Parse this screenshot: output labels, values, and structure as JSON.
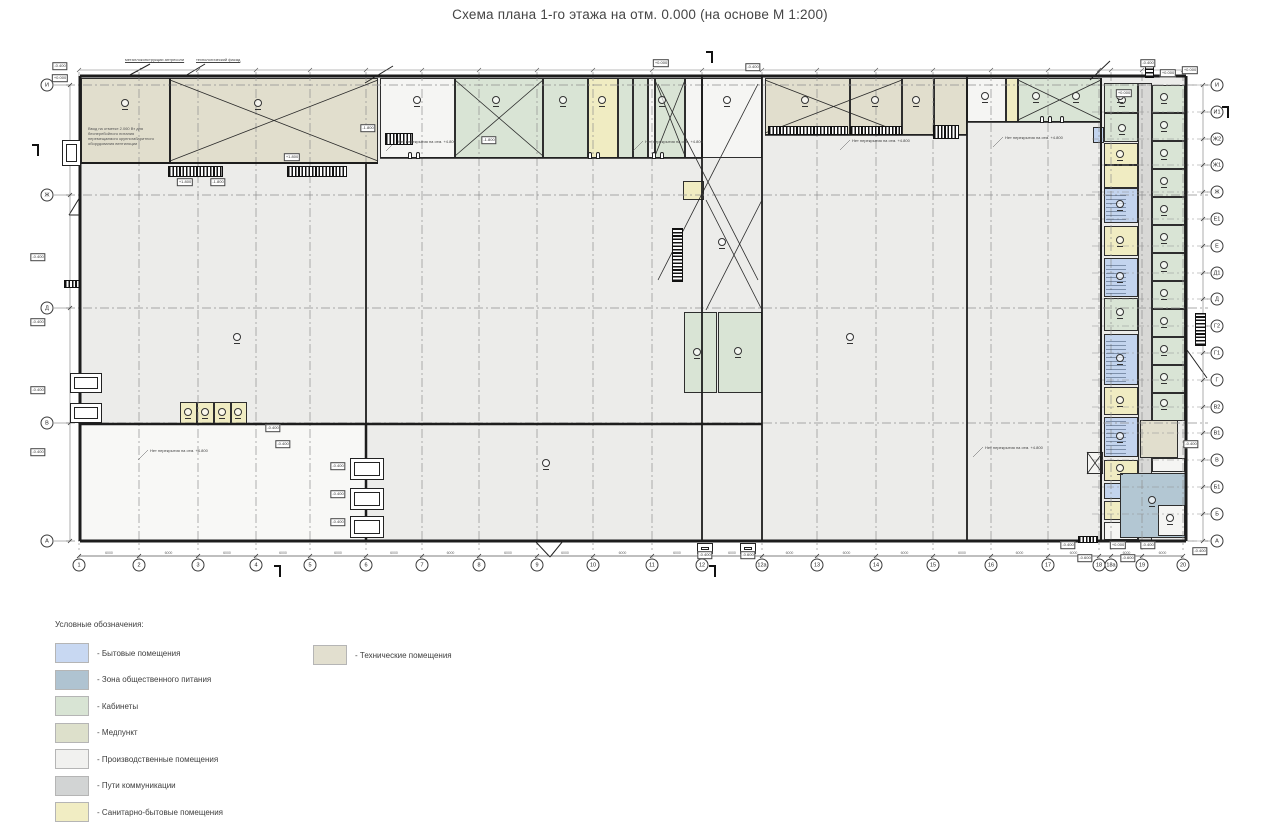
{
  "title": "Схема плана 1-го этажа на отм. 0.000 (на основе М 1:200)",
  "legend": {
    "title": "Условные обозначения:",
    "col1": [
      {
        "label": "- Бытовые помещения",
        "color": "#c8d8f2"
      },
      {
        "label": "- Зона общественного питания",
        "color": "#afc3d1"
      },
      {
        "label": "- Кабинеты",
        "color": "#d8e4d4"
      },
      {
        "label": "- Медпункт",
        "color": "#dde0cb"
      },
      {
        "label": "- Производственные помещения",
        "color": "#f1f1ef"
      },
      {
        "label": "- Пути коммуникации",
        "color": "#d2d4d4"
      },
      {
        "label": "- Санитарно-бытовые помещения",
        "color": "#f1edc3"
      }
    ],
    "col2": [
      {
        "label": "- Технические помещения",
        "color": "#e2dfcf"
      }
    ]
  },
  "colors": {
    "tech": "#e1decd",
    "green": "#d9e4d5",
    "sanitary": "#f0ecc2",
    "blue": "#c3d4ee",
    "bluegray": "#b3c7d3",
    "comm": "#d8d8d6",
    "white": "#f5f5f3",
    "floor": "#ececea",
    "cold": "#f8f8f6",
    "wall": "#1d1d1d",
    "grid": "#8f8f8f"
  },
  "axes": {
    "bottom": {
      "y": 565,
      "items": [
        {
          "label": "1",
          "x": 79
        },
        {
          "label": "2",
          "x": 139
        },
        {
          "label": "3",
          "x": 198
        },
        {
          "label": "4",
          "x": 256
        },
        {
          "label": "5",
          "x": 310
        },
        {
          "label": "6",
          "x": 366
        },
        {
          "label": "7",
          "x": 422
        },
        {
          "label": "8",
          "x": 479
        },
        {
          "label": "9",
          "x": 537
        },
        {
          "label": "10",
          "x": 593
        },
        {
          "label": "11",
          "x": 652
        },
        {
          "label": "12",
          "x": 702
        },
        {
          "label": "12а",
          "x": 762
        },
        {
          "label": "13",
          "x": 817
        },
        {
          "label": "14",
          "x": 876
        },
        {
          "label": "15",
          "x": 933
        },
        {
          "label": "16",
          "x": 991
        },
        {
          "label": "17",
          "x": 1048
        },
        {
          "label": "18",
          "x": 1099
        },
        {
          "label": "18а",
          "x": 1111
        },
        {
          "label": "19",
          "x": 1142
        },
        {
          "label": "20",
          "x": 1183
        }
      ]
    },
    "left": {
      "x": 47,
      "items": [
        {
          "label": "И",
          "y": 85
        },
        {
          "label": "Ж",
          "y": 195
        },
        {
          "label": "Д",
          "y": 308
        },
        {
          "label": "В",
          "y": 423
        },
        {
          "label": "А",
          "y": 541
        }
      ]
    },
    "right": {
      "x": 1217,
      "items": [
        {
          "label": "И",
          "y": 85
        },
        {
          "label": "И1",
          "y": 112
        },
        {
          "label": "Ж2",
          "y": 139
        },
        {
          "label": "Ж1",
          "y": 165
        },
        {
          "label": "Ж",
          "y": 192
        },
        {
          "label": "Е1",
          "y": 219
        },
        {
          "label": "Е",
          "y": 246
        },
        {
          "label": "Д1",
          "y": 273
        },
        {
          "label": "Д",
          "y": 299
        },
        {
          "label": "Г2",
          "y": 326
        },
        {
          "label": "Г1",
          "y": 353
        },
        {
          "label": "Г",
          "y": 380
        },
        {
          "label": "В2",
          "y": 407
        },
        {
          "label": "В1",
          "y": 433
        },
        {
          "label": "В",
          "y": 460
        },
        {
          "label": "Б1",
          "y": 487
        },
        {
          "label": "Б",
          "y": 514
        },
        {
          "label": "А",
          "y": 541
        }
      ]
    }
  },
  "zones": [
    [
      80,
      76,
      1107,
      465,
      "floor"
    ],
    [
      80,
      424,
      286,
      117,
      "cold"
    ]
  ],
  "rooms": [
    [
      81,
      78,
      89,
      85,
      "tech"
    ],
    [
      170,
      78,
      208,
      85,
      "tech"
    ],
    [
      380,
      78,
      75,
      80,
      "white"
    ],
    [
      455,
      78,
      88,
      80,
      "green"
    ],
    [
      543,
      78,
      45,
      80,
      "green"
    ],
    [
      588,
      78,
      30,
      80,
      "sanitary"
    ],
    [
      618,
      78,
      15,
      80,
      "green"
    ],
    [
      633,
      78,
      15,
      80,
      "green"
    ],
    [
      648,
      78,
      7,
      80,
      "white"
    ],
    [
      655,
      78,
      30,
      80,
      "green"
    ],
    [
      685,
      78,
      17,
      80,
      "white"
    ],
    [
      702,
      78,
      60,
      80,
      "white"
    ],
    [
      765,
      78,
      85,
      57,
      "tech"
    ],
    [
      850,
      78,
      52,
      57,
      "tech"
    ],
    [
      902,
      78,
      32,
      57,
      "tech"
    ],
    [
      934,
      78,
      33,
      57,
      "tech"
    ],
    [
      967,
      78,
      39,
      44,
      "white"
    ],
    [
      1006,
      78,
      12,
      44,
      "sanitary"
    ],
    [
      1018,
      78,
      83,
      44,
      "green"
    ],
    [
      683,
      181,
      21,
      19,
      "sanitary"
    ],
    [
      684,
      312,
      33,
      81,
      "green"
    ],
    [
      718,
      312,
      44,
      81,
      "green"
    ],
    [
      180,
      402,
      17,
      22,
      "sanitary"
    ],
    [
      197,
      402,
      17,
      22,
      "sanitary"
    ],
    [
      214,
      402,
      17,
      22,
      "sanitary"
    ],
    [
      231,
      402,
      16,
      22,
      "sanitary"
    ],
    [
      1093,
      127,
      11,
      16,
      "blue"
    ],
    [
      1087,
      452,
      16,
      22,
      "white"
    ],
    [
      1104,
      83,
      34,
      30,
      "green"
    ],
    [
      1104,
      113,
      34,
      29,
      "green"
    ],
    [
      1104,
      143,
      34,
      22,
      "sanitary"
    ],
    [
      1104,
      165,
      34,
      23,
      "sanitary"
    ],
    [
      1104,
      188,
      34,
      35,
      "blue"
    ],
    [
      1104,
      226,
      34,
      30,
      "sanitary"
    ],
    [
      1104,
      258,
      34,
      39,
      "blue"
    ],
    [
      1104,
      298,
      34,
      33,
      "green"
    ],
    [
      1104,
      334,
      34,
      51,
      "blue"
    ],
    [
      1104,
      387,
      34,
      28,
      "sanitary"
    ],
    [
      1104,
      417,
      34,
      40,
      "blue"
    ],
    [
      1104,
      460,
      34,
      21,
      "sanitary"
    ],
    [
      1104,
      483,
      34,
      16,
      "blue"
    ],
    [
      1104,
      501,
      34,
      19,
      "sanitary"
    ],
    [
      1104,
      522,
      34,
      18,
      "white"
    ],
    [
      1138,
      83,
      14,
      458,
      "comm"
    ],
    [
      1152,
      85,
      33,
      28,
      "green"
    ],
    [
      1152,
      113,
      33,
      28,
      "green"
    ],
    [
      1152,
      141,
      33,
      28,
      "green"
    ],
    [
      1152,
      169,
      33,
      28,
      "green"
    ],
    [
      1152,
      197,
      33,
      28,
      "green"
    ],
    [
      1152,
      225,
      33,
      28,
      "green"
    ],
    [
      1152,
      253,
      33,
      28,
      "green"
    ],
    [
      1152,
      281,
      33,
      28,
      "green"
    ],
    [
      1152,
      309,
      33,
      28,
      "green"
    ],
    [
      1152,
      337,
      33,
      28,
      "green"
    ],
    [
      1152,
      365,
      33,
      28,
      "green"
    ],
    [
      1152,
      393,
      33,
      28,
      "green"
    ],
    [
      1140,
      420,
      38,
      38,
      "tech"
    ],
    [
      1152,
      458,
      33,
      14,
      "white"
    ],
    [
      1120,
      473,
      67,
      65,
      "bluegray"
    ],
    [
      1158,
      505,
      27,
      31,
      "white"
    ]
  ],
  "walls": [
    [
      80,
      76,
      1186,
      76,
      3
    ],
    [
      80,
      541,
      1186,
      541,
      3
    ],
    [
      80,
      76,
      80,
      541,
      3
    ],
    [
      1186,
      76,
      1186,
      541,
      3
    ],
    [
      80,
      424,
      762,
      424,
      2.5
    ],
    [
      366,
      424,
      366,
      541,
      2.5
    ],
    [
      366,
      163,
      366,
      424,
      1.8
    ],
    [
      702,
      76,
      702,
      541,
      1.8
    ],
    [
      762,
      76,
      762,
      541,
      1.8
    ],
    [
      967,
      76,
      967,
      541,
      1.8
    ],
    [
      1101,
      78,
      1101,
      541,
      2
    ],
    [
      1185,
      76,
      1185,
      541,
      1
    ],
    [
      80,
      163,
      378,
      163,
      2
    ],
    [
      380,
      158,
      702,
      158,
      1.5
    ],
    [
      765,
      135,
      967,
      135,
      1.5
    ],
    [
      967,
      122,
      1101,
      122,
      1.5
    ],
    [
      170,
      78,
      170,
      163,
      1.2
    ]
  ],
  "braces": [
    [
      170,
      80,
      208,
      81
    ],
    [
      455,
      80,
      88,
      76
    ],
    [
      655,
      80,
      30,
      76
    ],
    [
      765,
      80,
      137,
      53
    ],
    [
      1018,
      80,
      83,
      40
    ],
    [
      658,
      84,
      100,
      196
    ],
    [
      706,
      200,
      56,
      110
    ],
    [
      1087,
      452,
      16,
      22
    ]
  ],
  "hatches": [
    [
      168,
      166,
      55,
      11,
      "v"
    ],
    [
      287,
      166,
      60,
      11,
      "v"
    ],
    [
      385,
      133,
      28,
      12,
      "v"
    ],
    [
      768,
      126,
      80,
      9,
      "v"
    ],
    [
      850,
      126,
      52,
      9,
      "v"
    ],
    [
      933,
      125,
      26,
      14,
      "v"
    ],
    [
      672,
      228,
      11,
      54,
      "h"
    ],
    [
      1195,
      313,
      11,
      33,
      "h"
    ],
    [
      1145,
      61,
      9,
      17,
      "h"
    ],
    [
      64,
      280,
      16,
      8,
      "v"
    ],
    [
      1078,
      536,
      20,
      7,
      "v"
    ],
    [
      1106,
      340,
      20,
      42,
      "f"
    ],
    [
      1106,
      420,
      20,
      34,
      "f"
    ],
    [
      1106,
      192,
      20,
      28,
      "f"
    ],
    [
      1106,
      262,
      20,
      32,
      "f"
    ]
  ],
  "docks": [
    [
      70,
      373,
      32,
      20
    ],
    [
      70,
      403,
      32,
      20
    ],
    [
      350,
      458,
      34,
      22
    ],
    [
      350,
      488,
      34,
      22
    ],
    [
      350,
      516,
      34,
      22
    ],
    [
      62,
      140,
      19,
      26
    ],
    [
      697,
      543,
      16,
      11
    ],
    [
      740,
      543,
      16,
      11
    ]
  ],
  "doors": [
    [
      408,
      152
    ],
    [
      416,
      152
    ],
    [
      588,
      152
    ],
    [
      596,
      152
    ],
    [
      652,
      152
    ],
    [
      660,
      152
    ],
    [
      1040,
      116
    ],
    [
      1048,
      116
    ],
    [
      1060,
      116
    ]
  ],
  "tags": [
    [
      60,
      66,
      "-0.400"
    ],
    [
      60,
      78,
      "+0.000"
    ],
    [
      38,
      257,
      "-0.400"
    ],
    [
      38,
      322,
      "-0.400"
    ],
    [
      38,
      390,
      "-0.400"
    ],
    [
      38,
      452,
      "-0.400"
    ],
    [
      292,
      157,
      "+1.800"
    ],
    [
      185,
      182,
      "+1.800"
    ],
    [
      218,
      182,
      "-1.800"
    ],
    [
      368,
      128,
      "-1.800"
    ],
    [
      489,
      140,
      "-1.800"
    ],
    [
      661,
      63,
      "+0.000"
    ],
    [
      753,
      67,
      "-0.400"
    ],
    [
      1124,
      93,
      "+0.000"
    ],
    [
      273,
      428,
      "-0.400"
    ],
    [
      283,
      444,
      "-0.400"
    ],
    [
      338,
      466,
      "-0.400"
    ],
    [
      338,
      494,
      "-0.400"
    ],
    [
      338,
      522,
      "-0.400"
    ],
    [
      705,
      555,
      "-0.400"
    ],
    [
      748,
      555,
      "-0.600"
    ],
    [
      1068,
      545,
      "-0.400"
    ],
    [
      1085,
      558,
      "-0.600"
    ],
    [
      1118,
      545,
      "+0.000"
    ],
    [
      1128,
      558,
      "-0.600"
    ],
    [
      1148,
      545,
      "-0.400"
    ],
    [
      1190,
      70,
      "+0.000"
    ],
    [
      1191,
      444,
      "-0.400"
    ],
    [
      1200,
      551,
      "-0.400"
    ],
    [
      1148,
      63,
      "-0.400"
    ],
    [
      1168,
      73,
      "+0.000"
    ]
  ],
  "callouts": [
    [
      398,
      139,
      "Нет перекрытия на отм. +4.800"
    ],
    [
      645,
      139,
      "Нет перекрытия на отм. +4.800"
    ],
    [
      852,
      138,
      "Нет перекрытия на отм. +4.800"
    ],
    [
      1005,
      135,
      "Нет перекрытия на отм. +4.800"
    ],
    [
      985,
      445,
      "Нет перекрытия на отм. +4.800"
    ],
    [
      150,
      448,
      "Нет перекрытия на отм. +4.800"
    ]
  ],
  "note": {
    "x": 88,
    "y": 126,
    "lines": [
      "Ввод на отметке 2.060 Вт для",
      "бесперебойного питания",
      "перемещаемого крупногабаритного",
      "оборудования вентиляции"
    ]
  },
  "top_labels": [
    {
      "x": 125,
      "y": 57,
      "text": "металлоконструкции антресоли"
    },
    {
      "x": 196,
      "y": 57,
      "text": "технологический фасад"
    }
  ],
  "markers": [
    [
      125,
      103
    ],
    [
      258,
      103
    ],
    [
      417,
      100
    ],
    [
      496,
      100
    ],
    [
      563,
      100
    ],
    [
      602,
      100
    ],
    [
      662,
      100
    ],
    [
      727,
      100
    ],
    [
      805,
      100
    ],
    [
      875,
      100
    ],
    [
      916,
      100
    ],
    [
      985,
      96
    ],
    [
      1036,
      96
    ],
    [
      1076,
      96
    ],
    [
      1122,
      100
    ],
    [
      1122,
      128
    ],
    [
      237,
      337
    ],
    [
      546,
      463
    ],
    [
      722,
      242
    ],
    [
      850,
      337
    ],
    [
      697,
      352
    ],
    [
      738,
      351
    ],
    [
      188,
      412
    ],
    [
      205,
      412
    ],
    [
      222,
      412
    ],
    [
      238,
      412
    ],
    [
      1164,
      97
    ],
    [
      1164,
      125
    ],
    [
      1164,
      153
    ],
    [
      1164,
      181
    ],
    [
      1164,
      209
    ],
    [
      1164,
      237
    ],
    [
      1164,
      265
    ],
    [
      1164,
      293
    ],
    [
      1164,
      321
    ],
    [
      1164,
      349
    ],
    [
      1164,
      377
    ],
    [
      1164,
      403
    ],
    [
      1120,
      96
    ],
    [
      1120,
      154
    ],
    [
      1120,
      204
    ],
    [
      1120,
      240
    ],
    [
      1120,
      276
    ],
    [
      1120,
      312
    ],
    [
      1120,
      358
    ],
    [
      1120,
      400
    ],
    [
      1120,
      436
    ],
    [
      1120,
      468
    ],
    [
      1152,
      500
    ],
    [
      1170,
      518
    ]
  ],
  "section_marks": [
    [
      38,
      150
    ],
    [
      712,
      57
    ],
    [
      280,
      571
    ],
    [
      715,
      571
    ],
    [
      1228,
      112
    ]
  ],
  "extra_lines": [
    [
      365,
      83,
      393,
      66
    ],
    [
      1090,
      80,
      1110,
      61
    ],
    [
      150,
      64,
      128,
      76
    ],
    [
      205,
      64,
      185,
      76
    ],
    [
      80,
      197,
      69,
      215
    ],
    [
      69,
      215,
      80,
      215
    ],
    [
      535,
      541,
      550,
      557
    ],
    [
      550,
      557,
      563,
      541
    ],
    [
      1187,
      350,
      1207,
      378
    ]
  ],
  "dims": {
    "bottom_y": 556,
    "top_y": 70,
    "left_x": 70,
    "right_x": 1203,
    "span_label": "6000"
  }
}
